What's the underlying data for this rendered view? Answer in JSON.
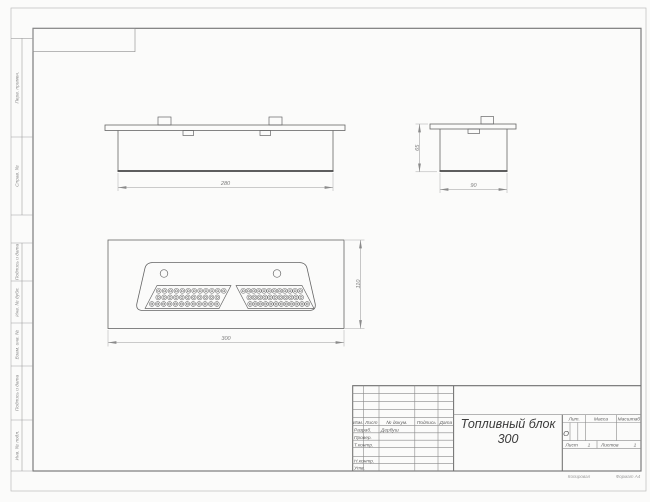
{
  "drawing": {
    "dimensions": {
      "front_length": "280",
      "side_height": "65",
      "side_width": "90",
      "plan_length": "300",
      "plan_width": "110"
    },
    "perforation": {
      "rows": 3,
      "columns_per_row": [
        12,
        11,
        12
      ],
      "panels": 2
    }
  },
  "title_block": {
    "header": {
      "izm": "Изм.",
      "list": "Лист",
      "doc": "№ докум.",
      "sign": "Подпись",
      "date": "Дата"
    },
    "rows": [
      {
        "label": "Разраб.",
        "value": "Дербуш"
      },
      {
        "label": "Провер.",
        "value": ""
      },
      {
        "label": "Т.контр.",
        "value": ""
      },
      {
        "label": "Н.контр.",
        "value": ""
      },
      {
        "label": "Утв.",
        "value": ""
      }
    ],
    "doc_name": {
      "line1": "Топливный блок",
      "line2": "300"
    },
    "lit": {
      "label": "Лит.",
      "value": "О"
    },
    "mass": {
      "label": "Масса",
      "value": ""
    },
    "scale": {
      "label": "Масштаб",
      "value": ""
    },
    "sheet": {
      "label": "Лист",
      "value": "1"
    },
    "sheets": {
      "label": "Листов",
      "value": "1"
    }
  },
  "margins": {
    "left_labels": [
      "Перв. примен.",
      "Справ. №",
      "Подпись и дата",
      "Инв. № дубл.",
      "Взам. инв. №",
      "Подпись и дата",
      "Инв. № подл."
    ],
    "footer": {
      "copied": "Копировал",
      "format": "Формат А4"
    }
  }
}
